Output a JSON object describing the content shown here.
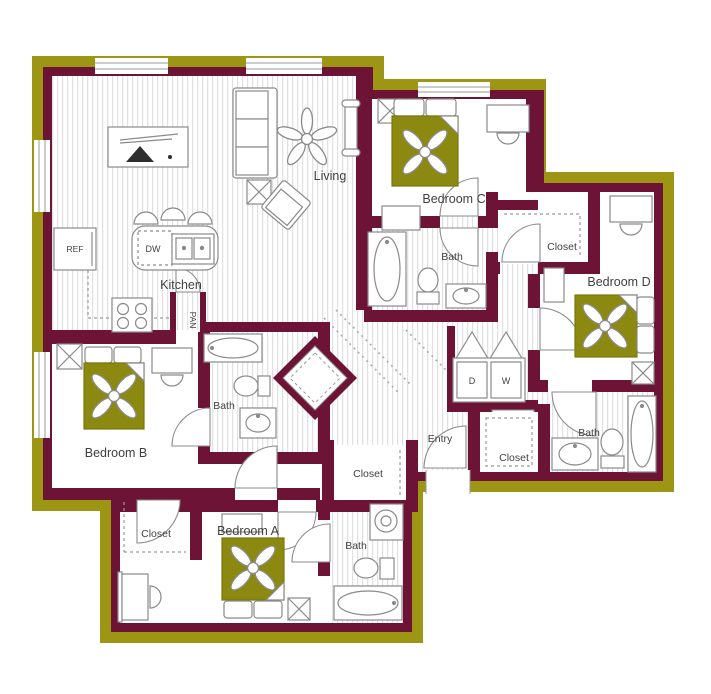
{
  "palette": {
    "outer_band_olive": "#9c9614",
    "wall_maroon": "#6d1335",
    "bed_olive": "#8b8910",
    "floor_stripe": "#dedede",
    "furniture_outline": "#8a8a8a",
    "label_color": "#3f3f3f"
  },
  "labels": {
    "living": "Living",
    "kitchen": "Kitchen",
    "ref": "REF",
    "dw": "DW",
    "pan": "PAN",
    "bedroom_a": "Bedroom A",
    "bedroom_b": "Bedroom B",
    "bedroom_c": "Bedroom C",
    "bedroom_d": "Bedroom D",
    "bath_upper": "Bath",
    "bath_left": "Bath",
    "bath_lower": "Bath",
    "bath_right": "Bath",
    "closet_cd": "Closet",
    "closet_hall": "Closet",
    "closet_b": "Closet",
    "closet_d": "Closet",
    "entry": "Entry",
    "dryer": "D",
    "washer": "W"
  }
}
